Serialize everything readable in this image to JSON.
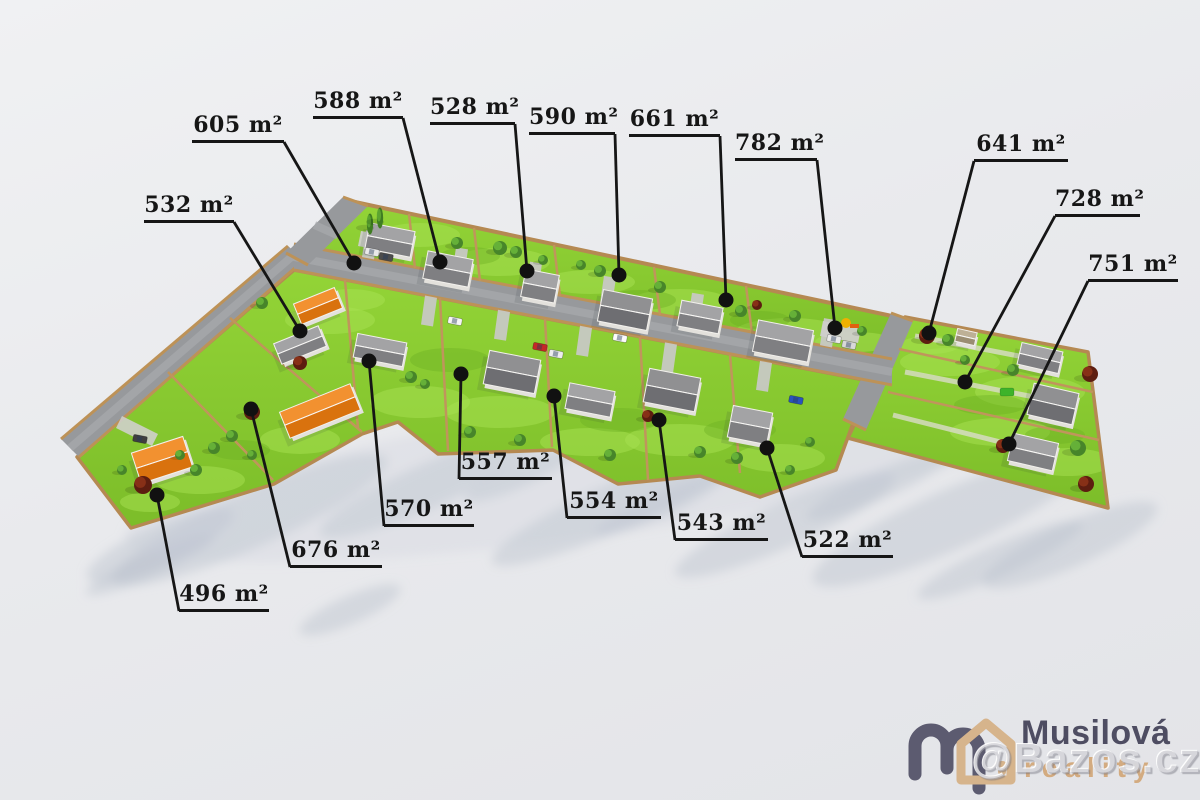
{
  "plots": [
    {
      "id": "532",
      "area": "532 m²"
    },
    {
      "id": "605",
      "area": "605 m²"
    },
    {
      "id": "588",
      "area": "588 m²"
    },
    {
      "id": "528",
      "area": "528 m²"
    },
    {
      "id": "590",
      "area": "590 m²"
    },
    {
      "id": "661",
      "area": "661 m²"
    },
    {
      "id": "782",
      "area": "782 m²"
    },
    {
      "id": "641",
      "area": "641 m²"
    },
    {
      "id": "728",
      "area": "728 m²"
    },
    {
      "id": "751",
      "area": "751 m²"
    },
    {
      "id": "557",
      "area": "557 m²"
    },
    {
      "id": "570",
      "area": "570 m²"
    },
    {
      "id": "554",
      "area": "554 m²"
    },
    {
      "id": "543",
      "area": "543 m²"
    },
    {
      "id": "522",
      "area": "522 m²"
    },
    {
      "id": "676",
      "area": "676 m²"
    },
    {
      "id": "496",
      "area": "496 m²"
    }
  ],
  "unit": "m²",
  "branding": {
    "company": "Musilová",
    "tagline": "reality",
    "watermark": "@Bazos.cz"
  },
  "colors": {
    "lawn": "#85C62E",
    "lawn_light": "#A8E152",
    "road": "#97999C",
    "plot_border": "#C0955C",
    "roof_gray": "#8E8E90",
    "roof_orange": "#E8821E",
    "label": "#161616",
    "logo_slate": "#5C5B70",
    "logo_tan": "#D6B48C"
  }
}
